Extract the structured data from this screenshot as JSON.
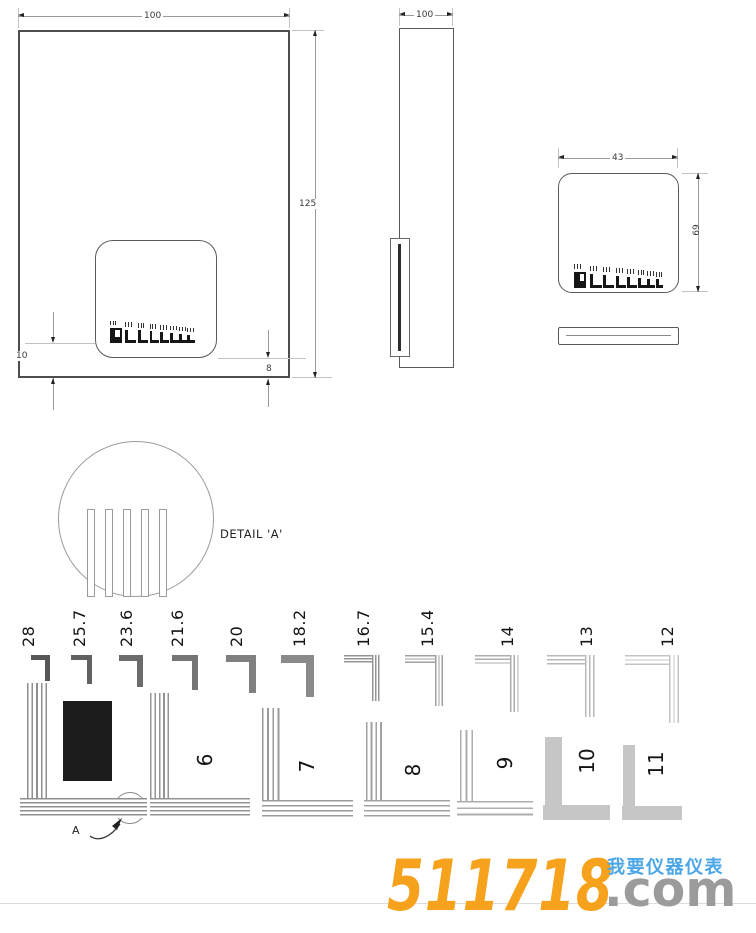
{
  "drawing": {
    "front_view": {
      "width": "100",
      "height": "125",
      "comb_offset_left": "10",
      "comb_offset_right": "8"
    },
    "side_view": {
      "width": "100"
    },
    "detail_view": {
      "width": "43",
      "height": "69"
    },
    "detail_callout": {
      "label": "DETAIL 'A'",
      "marker": "A"
    },
    "detail_bars": 5
  },
  "pattern": {
    "comb_elements": 8,
    "pitch_labels": [
      "28",
      "25.7",
      "23.6",
      "21.6",
      "20",
      "18.2",
      "16.7",
      "15.4",
      "14",
      "13",
      "12"
    ],
    "group_labels": [
      "6",
      "7",
      "8",
      "9",
      "10",
      "11"
    ],
    "pitch_items": [
      {
        "label": "28",
        "x": 31,
        "w": 19,
        "h": 26,
        "t": 5,
        "lx": 29,
        "color": "#575757",
        "striped": false
      },
      {
        "label": "25.7",
        "x": 71,
        "w": 21,
        "h": 29,
        "t": 5,
        "lx": 80,
        "color": "#616161",
        "striped": false
      },
      {
        "label": "23.6",
        "x": 119,
        "w": 24,
        "h": 32,
        "t": 6,
        "lx": 127,
        "color": "#6b6b6b",
        "striped": false
      },
      {
        "label": "21.6",
        "x": 172,
        "w": 26,
        "h": 35,
        "t": 6,
        "lx": 178,
        "color": "#757575",
        "striped": false
      },
      {
        "label": "20",
        "x": 226,
        "w": 30,
        "h": 38,
        "t": 7,
        "lx": 237,
        "color": "#808080",
        "striped": false
      },
      {
        "label": "18.2",
        "x": 281,
        "w": 33,
        "h": 42,
        "t": 8,
        "lx": 300,
        "color": "#8a8a8a",
        "striped": false
      },
      {
        "label": "16.7",
        "x": 344,
        "w": 37,
        "h": 46,
        "t": 9,
        "lx": 364,
        "color": "#949494",
        "striped": true
      },
      {
        "label": "15.4",
        "x": 405,
        "w": 40,
        "h": 51,
        "t": 10,
        "lx": 428,
        "color": "#a0a0a0",
        "striped": true
      },
      {
        "label": "14",
        "x": 475,
        "w": 46,
        "h": 57,
        "t": 11,
        "lx": 508,
        "color": "#aeaeae",
        "striped": true
      },
      {
        "label": "13",
        "x": 547,
        "w": 50,
        "h": 62,
        "t": 12,
        "lx": 587,
        "color": "#b9b9b9",
        "striped": true
      },
      {
        "label": "12",
        "x": 625,
        "w": 57,
        "h": 68,
        "t": 13,
        "lx": 668,
        "color": "#c4c4c4",
        "striped": true
      }
    ],
    "group_items": [
      {
        "label": "",
        "vx": 27,
        "vy": 683,
        "vw": 23,
        "vh": 115,
        "hx": 20,
        "hy": 798,
        "hw": 127,
        "hh": 20,
        "stripes": 5,
        "tone": "#8f8f8f",
        "lcx": 0,
        "lcy": 0
      },
      {
        "label": "6",
        "vx": 150,
        "vy": 693,
        "vw": 22,
        "vh": 105,
        "hx": 150,
        "hy": 798,
        "hw": 100,
        "hh": 20,
        "stripes": 5,
        "tone": "#949494",
        "lcx": 205,
        "lcy": 760
      },
      {
        "label": "7",
        "vx": 262,
        "vy": 708,
        "vw": 21,
        "vh": 92,
        "hx": 262,
        "hy": 800,
        "hw": 91,
        "hh": 20,
        "stripes": 4,
        "tone": "#9a9a9a",
        "lcx": 307,
        "lcy": 766
      },
      {
        "label": "8",
        "vx": 366,
        "vy": 722,
        "vw": 19,
        "vh": 78,
        "hx": 364,
        "hy": 800,
        "hw": 86,
        "hh": 20,
        "stripes": 4,
        "tone": "#a2a2a2",
        "lcx": 413,
        "lcy": 770
      },
      {
        "label": "9",
        "vx": 460,
        "vy": 730,
        "vw": 17,
        "vh": 71,
        "hx": 457,
        "hy": 801,
        "hw": 76,
        "hh": 19,
        "stripes": 3,
        "tone": "#adadad",
        "lcx": 505,
        "lcy": 763
      },
      {
        "label": "10",
        "vx": 545,
        "vy": 737,
        "vw": 17,
        "vh": 68,
        "hx": 543,
        "hy": 805,
        "hw": 67,
        "hh": 15,
        "stripes": 0,
        "tone": "#c6c6c6",
        "lcx": 587,
        "lcy": 761
      },
      {
        "label": "11",
        "vx": 623,
        "vy": 745,
        "vw": 12,
        "vh": 61,
        "hx": 622,
        "hy": 806,
        "hw": 60,
        "hh": 14,
        "stripes": 0,
        "tone": "#c6c6c6",
        "lcx": 656,
        "lcy": 764
      }
    ],
    "black_rect": {
      "x": 63,
      "y": 701,
      "w": 49,
      "h": 80,
      "color": "#1c1c1c"
    }
  },
  "watermark": {
    "number": "511718",
    "domain_suffix": ".com",
    "tagline": "我要仪器仪表",
    "number_color": "#F7A21C",
    "suffix_color": "#9B9B9B",
    "tagline_color": "#4BA6E8"
  },
  "colors": {
    "line": "#9a9a9a",
    "outline": "#4e4e4e",
    "ink": "#161616",
    "light_fill": "#c6c6c6"
  }
}
